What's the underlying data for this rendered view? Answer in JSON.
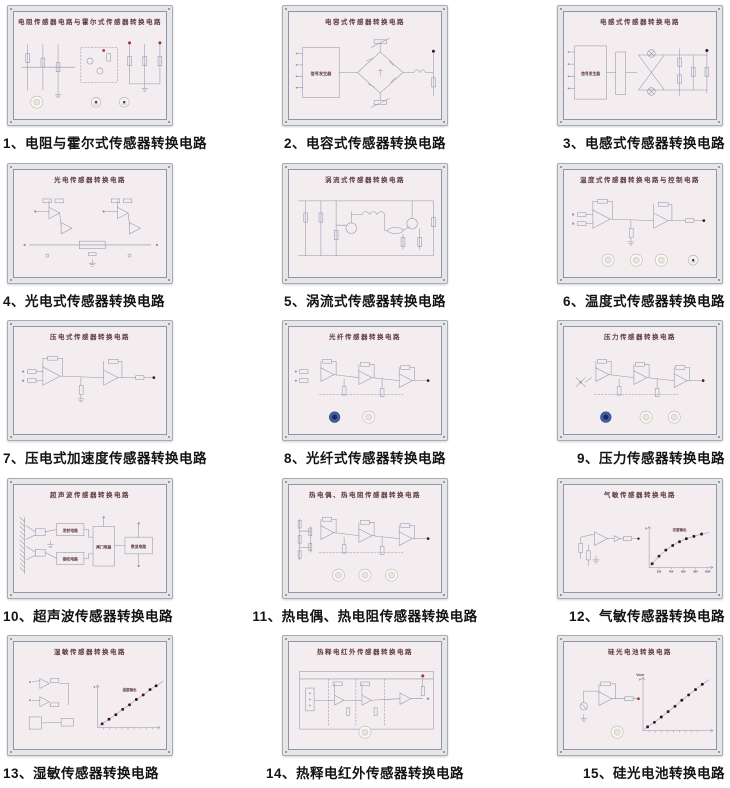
{
  "page": {
    "background": "#ffffff",
    "description_cn": "传感器转换电路挂板目录图",
    "grid": {
      "columns": 3,
      "rows": 5
    }
  },
  "colors": {
    "frame": "#e6e6e9",
    "frame_border": "#a6abb4",
    "board": "#f4edf0",
    "board_border": "#8e96a8",
    "line": "#8a94ab",
    "text_dark": "#5c3742",
    "caption": "#141414",
    "dot_maroon": "#451424",
    "terminal_red": "#a83038",
    "knob_white": "#f7f6f2",
    "knob_blue": "#3f5fa8"
  },
  "panels": [
    {
      "id": 1,
      "caption": "1、电阻与霍尔式传感器转换电路",
      "board_title": "电阻传感器电路与霍尔式传感器转换电路",
      "sketch": "resistor-network",
      "knobs": [
        {
          "type": "white",
          "x": 30
        },
        {
          "type": "meter",
          "x": 108
        },
        {
          "type": "meter",
          "x": 145
        }
      ]
    },
    {
      "id": 2,
      "caption": "2、电容式传感器转换电路",
      "board_title": "电容式传感器转换电路",
      "sketch": "bridge",
      "labels": {
        "box": "信号发生器"
      }
    },
    {
      "id": 3,
      "caption": "3、电感式传感器转换电路",
      "board_title": "电感式传感器转换电路",
      "sketch": "bridge-x",
      "labels": {
        "box": "信号发生器"
      }
    },
    {
      "id": 4,
      "caption": "4、光电式传感器转换电路",
      "board_title": "光电传感器转换电路",
      "sketch": "opamp-quad"
    },
    {
      "id": 5,
      "caption": "5、涡流式传感器转换电路",
      "board_title": "涡流式传感器转换电路",
      "sketch": "transistor-net"
    },
    {
      "id": 6,
      "caption": "6、温度式传感器转换电路",
      "board_title": "温度式传感器转换电路与控制电路",
      "sketch": "opamp-duo",
      "knobs": [
        {
          "type": "white",
          "x": 58
        },
        {
          "type": "white",
          "x": 95
        },
        {
          "type": "white",
          "x": 128
        },
        {
          "type": "meter",
          "x": 170
        }
      ]
    },
    {
      "id": 7,
      "caption": "7、压电式加速度传感器转换电路",
      "board_title": "压电式传感器转换电路",
      "sketch": "opamp-duo"
    },
    {
      "id": 8,
      "caption": "8、光纤式传感器转换电路",
      "board_title": "光纤传感器转换电路",
      "sketch": "opamp-trio",
      "knobs": [
        {
          "type": "blue",
          "x": 60
        },
        {
          "type": "white",
          "x": 105
        }
      ]
    },
    {
      "id": 9,
      "caption": "9、压力传感器转换电路",
      "board_title": "压力传感器转换电路",
      "sketch": "opamp-trio",
      "variant": "x-input",
      "knobs": [
        {
          "type": "blue",
          "x": 55
        },
        {
          "type": "white",
          "x": 108
        },
        {
          "type": "white",
          "x": 145
        }
      ]
    },
    {
      "id": 10,
      "caption": "10、超声波传感器转换电路",
      "board_title": "超声波传感器转换电路",
      "sketch": "blocks",
      "labels": {
        "blocks": [
          "发射电路",
          "接收电路",
          "闸门电路",
          "数显电路"
        ]
      }
    },
    {
      "id": 11,
      "caption": "11、热电偶、热电阻传感器转换电路",
      "board_title": "热电偶、热电阻传感器转换电路",
      "sketch": "opamp-trio",
      "variant": "grid-input",
      "knobs": [
        {
          "type": "white",
          "x": 65
        },
        {
          "type": "white",
          "x": 100
        },
        {
          "type": "white",
          "x": 135
        }
      ]
    },
    {
      "id": 12,
      "caption": "12、气敏传感器转换电路",
      "board_title": "气敏传感器转换电路",
      "sketch": "opamp-graph",
      "graph": {
        "shape": "saturate",
        "label": "浓度输出",
        "label_pos": [
          152,
          36
        ],
        "origin": [
          112,
          84
        ],
        "ytop": 30,
        "xend": 196,
        "x_ticks": [
          "200",
          "400",
          "600",
          "800",
          "1000"
        ],
        "points": [
          [
            116,
            79
          ],
          [
            125,
            69
          ],
          [
            134,
            61
          ],
          [
            143,
            55
          ],
          [
            152,
            50
          ],
          [
            161,
            46
          ],
          [
            171,
            43
          ],
          [
            181,
            40
          ]
        ]
      }
    },
    {
      "id": 13,
      "caption": "13、湿敏传感器转换电路",
      "board_title": "湿敏传感器转换电路",
      "sketch": "opamp-graph",
      "variant": "dual-amp",
      "graph": {
        "shape": "linear",
        "label": "湿度输出",
        "label_pos": [
          152,
          40
        ],
        "origin": [
          110,
          88
        ],
        "ytop": 32,
        "xend": 192,
        "x_ticks": [],
        "points": [
          [
            116,
            83
          ],
          [
            125,
            77
          ],
          [
            134,
            71
          ],
          [
            143,
            64
          ],
          [
            152,
            58
          ],
          [
            161,
            51
          ],
          [
            170,
            45
          ],
          [
            179,
            38
          ],
          [
            187,
            33
          ]
        ]
      }
    },
    {
      "id": 14,
      "caption": "14、热释电红外传感器转换电路",
      "board_title": "热释电红外传感器转换电路",
      "sketch": "transistor-chain",
      "knobs": [
        {
          "type": "white",
          "x": 100
        }
      ]
    },
    {
      "id": 15,
      "caption": "15、硅光电池转换电路",
      "board_title": "硅光电池转换电路",
      "sketch": "opamp-graph",
      "variant": "photocell",
      "graph": {
        "shape": "linear",
        "label": "Vout",
        "label_pos": [
          100,
          20
        ],
        "origin": [
          104,
          92
        ],
        "ytop": 22,
        "xend": 196,
        "x_ticks": [],
        "points": [
          [
            110,
            87
          ],
          [
            119,
            81
          ],
          [
            128,
            74
          ],
          [
            137,
            67
          ],
          [
            146,
            60
          ],
          [
            155,
            52
          ],
          [
            164,
            45
          ],
          [
            173,
            38
          ],
          [
            182,
            31
          ]
        ]
      },
      "knobs": [
        {
          "type": "white",
          "x": 70
        }
      ]
    }
  ]
}
